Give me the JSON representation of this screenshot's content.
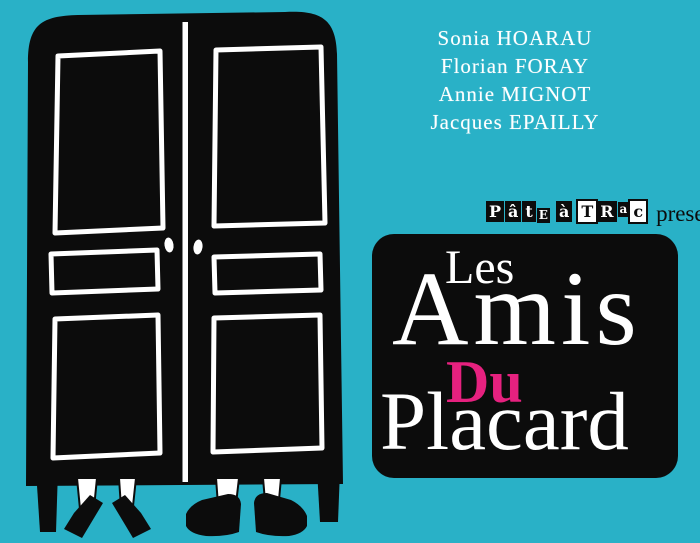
{
  "colors": {
    "background": "#29b1c7",
    "ink": "#0c0c0c",
    "paper": "#ffffff",
    "accent_pink": "#e6217f"
  },
  "cast": {
    "names": [
      "Sonia HOARAU",
      "Florian FORAY",
      "Annie MIGNOT",
      "Jacques EPAILLY"
    ]
  },
  "producer": {
    "name": "Pâte à Trac",
    "letters": [
      "P",
      "â",
      "t",
      "E",
      "à",
      "T",
      "R",
      "a",
      "c"
    ],
    "presents": "presente"
  },
  "title": {
    "line1": "Les",
    "line2": "Amis",
    "line3": "Du",
    "line4": "Placard"
  }
}
